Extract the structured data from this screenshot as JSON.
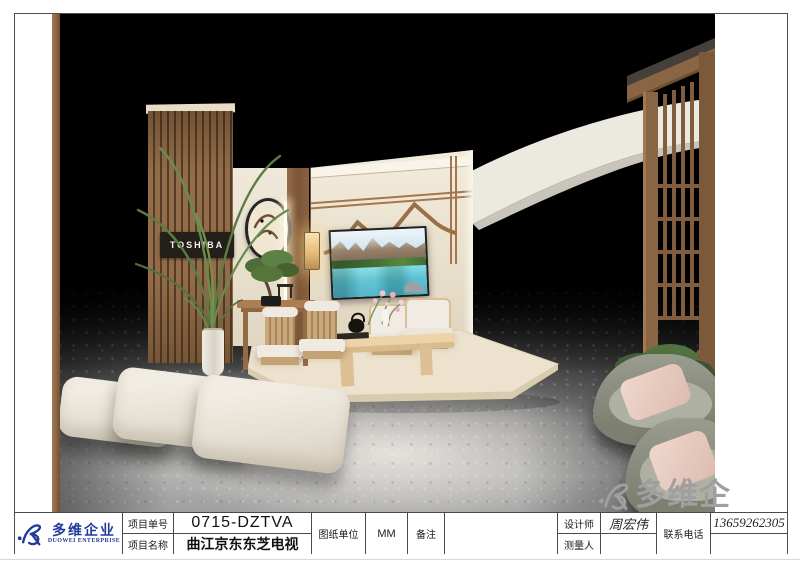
{
  "document": {
    "logo": {
      "name_cn": "多维企业",
      "name_en": "DUOWEI ENTERPRISE"
    },
    "watermark": {
      "text": "多维企"
    },
    "rendering": {
      "brand_sign": "TOSHIBA"
    },
    "title_block": {
      "project_no_label": "项目单号",
      "project_no": "0715-DZTVA",
      "project_name_label": "项目名称",
      "project_name": "曲江京东东芝电视",
      "drawing_unit_label": "图纸单位",
      "drawing_unit": "MM",
      "remarks_label": "备注",
      "remarks": "",
      "designer_label": "设计师",
      "designer": "周宏伟",
      "surveyor_label": "测量人",
      "surveyor": "",
      "phone_label": "联系电话",
      "phone": "13659262305"
    },
    "colors": {
      "brand_blue": "#223a9b",
      "watermark_gray": "#9f9f9f",
      "wall_cream": "#ece4d2",
      "wood_brown": "#8a6543"
    }
  }
}
